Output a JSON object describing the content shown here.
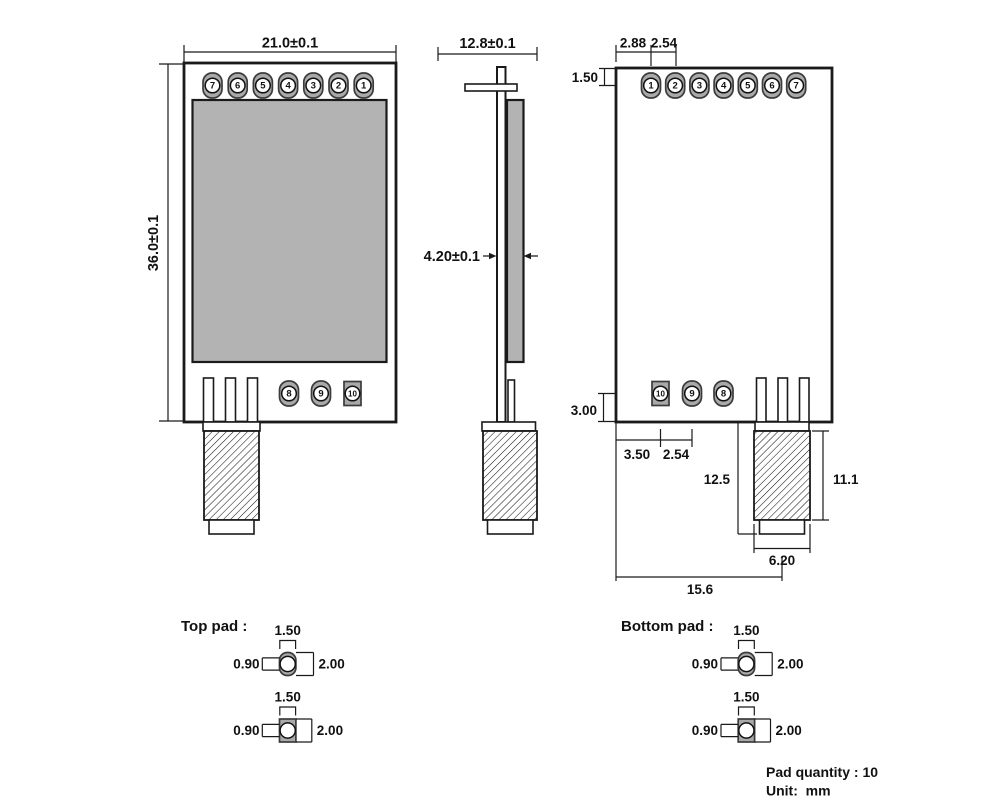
{
  "front_view": {
    "width_dim": "21.0±0.1",
    "height_dim": "36.0±0.1",
    "top_pins": [
      "7",
      "6",
      "5",
      "4",
      "3",
      "2",
      "1"
    ],
    "bottom_pins": [
      "8",
      "9",
      "10"
    ]
  },
  "side_view": {
    "width_dim": "12.8±0.1",
    "thickness_dim": "4.20±0.1"
  },
  "back_view": {
    "edge_to_pin1_dim": "2.88",
    "pin_pitch_dim": "2.54",
    "pin_row_offset_dim": "1.50",
    "bottom_pad_offset_dim": "3.00",
    "edge_to_pad10_dim": "3.50",
    "bottom_pad_pitch_dim": "2.54",
    "antenna_length_dim": "12.5",
    "antenna_body_length_dim": "11.1",
    "antenna_tip_width_dim": "6.20",
    "antenna_center_offset_dim": "15.6",
    "top_pins": [
      "1",
      "2",
      "3",
      "4",
      "5",
      "6",
      "7"
    ],
    "bottom_pins": [
      "10",
      "9",
      "8"
    ]
  },
  "pad_details": {
    "top_label": "Top pad :",
    "bottom_label": "Bottom pad :",
    "pad_width_dim": "1.50",
    "hole_dim": "0.90",
    "pad_height_dim": "2.00"
  },
  "notes": {
    "pad_quantity": "Pad quantity : 10",
    "unit": "Unit:  mm"
  },
  "colors": {
    "shield_gray": "#b3b3b3",
    "pad_gray": "#a9a9a9",
    "line_black": "#1a1a1a"
  }
}
